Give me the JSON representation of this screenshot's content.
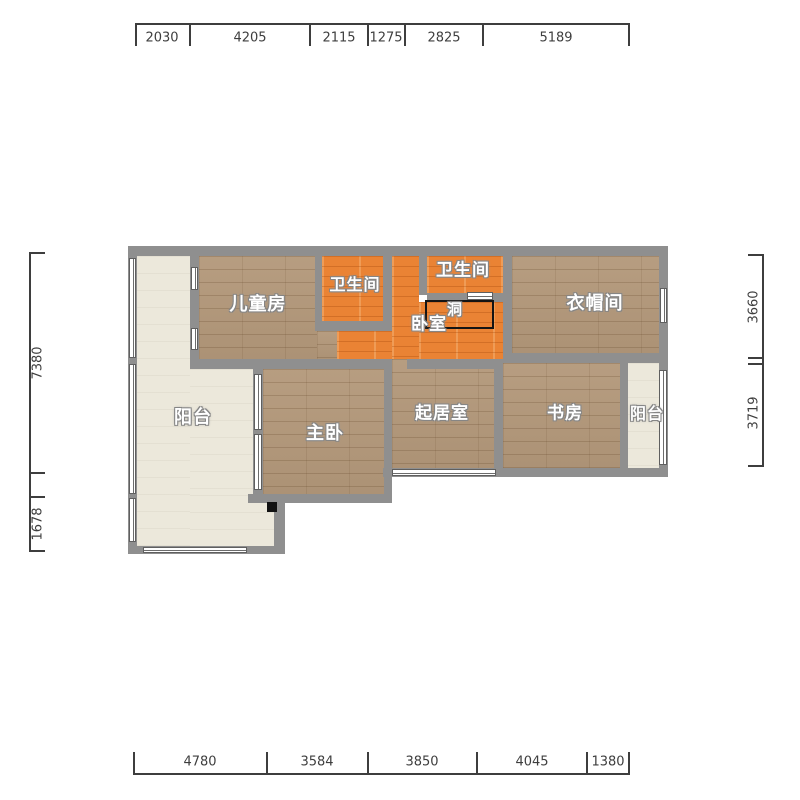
{
  "plan": {
    "rooms": [
      {
        "name": "children-room",
        "label": "儿童房"
      },
      {
        "name": "bathroom-left",
        "label": "卫生间"
      },
      {
        "name": "bathroom-right",
        "label": "卫生间"
      },
      {
        "name": "bedroom",
        "label": "卧室"
      },
      {
        "name": "hole",
        "label": "洞"
      },
      {
        "name": "cloakroom",
        "label": "衣帽间"
      },
      {
        "name": "balcony-left",
        "label": "阳台"
      },
      {
        "name": "master-bedroom",
        "label": "主卧"
      },
      {
        "name": "living-room",
        "label": "起居室"
      },
      {
        "name": "study",
        "label": "书房"
      },
      {
        "name": "balcony-right",
        "label": "阳台"
      }
    ],
    "dimensions": {
      "top": [
        "2030",
        "4205",
        "2115",
        "1275",
        "2825",
        "5189"
      ],
      "bottom": [
        "4780",
        "3584",
        "3850",
        "4045",
        "1380"
      ],
      "left": [
        "7380",
        "1678"
      ],
      "right": [
        "3660",
        "3719"
      ]
    },
    "colors": {
      "wall": "#8f8f8f",
      "wood": "#b3987a",
      "orange": "#ea8334",
      "cream": "#ece8db",
      "window": "#ffffff",
      "dim": "#3e3e3e"
    }
  }
}
